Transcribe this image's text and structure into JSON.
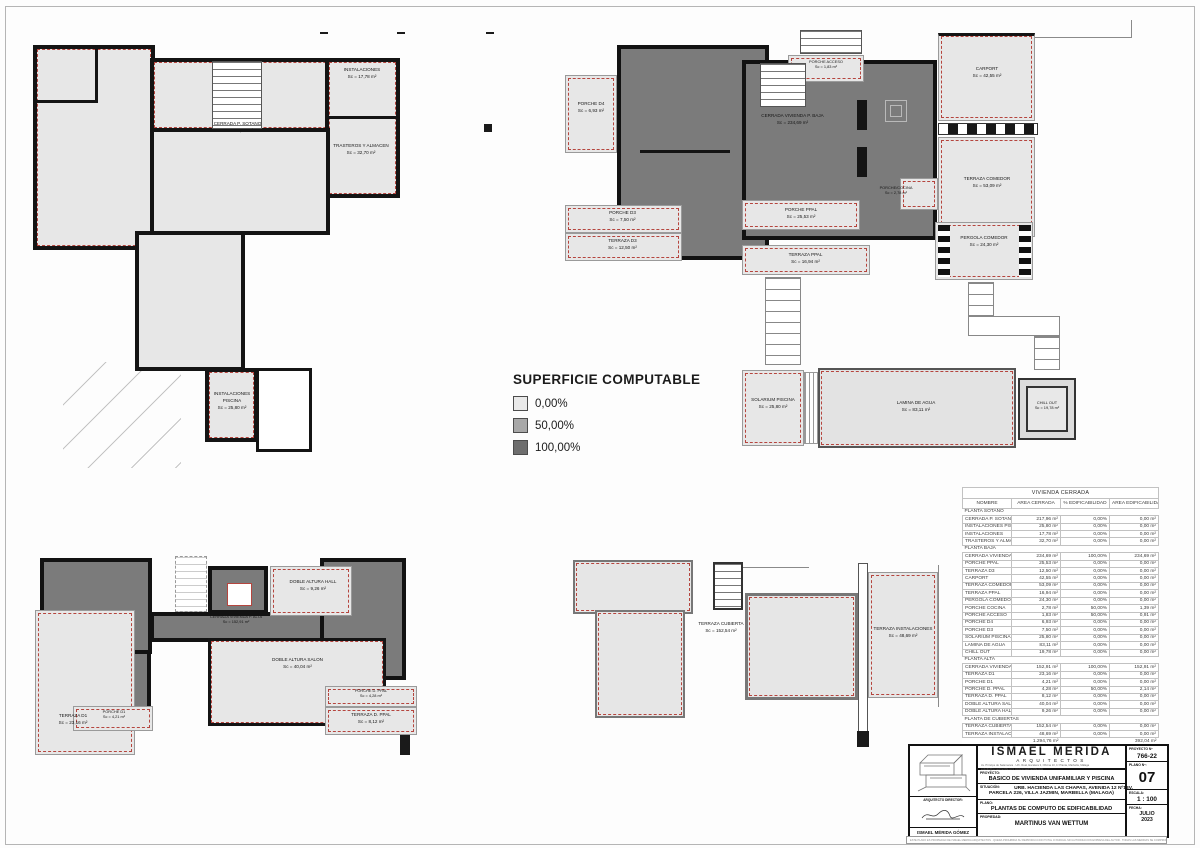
{
  "legend": {
    "title": "SUPERFICIE COMPUTABLE",
    "items": [
      {
        "label": "0,00%",
        "color": "#e9e9e9"
      },
      {
        "label": "50,00%",
        "color": "#a8a8a8"
      },
      {
        "label": "100,00%",
        "color": "#6e6e6e"
      }
    ]
  },
  "colors": {
    "pct0": "#e7e7e7",
    "pct50": "#a8a8a8",
    "pct100": "#7b7b7b",
    "wall": "#141414",
    "red_dash": "#b5453e"
  },
  "plans": {
    "sotano": {
      "rooms": [
        {
          "name": "INSTALACIONES",
          "area": "Sc = 17,78 m²"
        },
        {
          "name": "CERRADA P. SOTANO",
          "area": "Sc = 217,96 m²"
        },
        {
          "name": "TRASTEROS Y ALMACEN",
          "area": "Sc = 32,70 m²"
        },
        {
          "name": "INSTALACIONES PISCINA",
          "area": "Sc = 25,80 m²"
        }
      ]
    },
    "baja": {
      "rooms": [
        {
          "name": "PORCHE D4",
          "area": "Sc = 6,93 m²"
        },
        {
          "name": "PORCHE ACCESO",
          "area": "Sc = 1,83 m²"
        },
        {
          "name": "CERRADA VIVIENDA P. BAJA",
          "area": "Sc = 234,69 m²"
        },
        {
          "name": "CARPORT",
          "area": "Sc = 42,55 m²"
        },
        {
          "name": "TERRAZA COMEDOR",
          "area": "Sc = 53,09 m²"
        },
        {
          "name": "PORCHE/COCINA",
          "area": "Sc = 2,78 m²"
        },
        {
          "name": "PERGOLA COMEDOR",
          "area": "Sc = 24,30 m²"
        },
        {
          "name": "PORCHE D3",
          "area": "Sc = 7,50 m²"
        },
        {
          "name": "TERRAZA D3",
          "area": "Sc = 12,50 m²"
        },
        {
          "name": "PORCHE PPAL",
          "area": "Sc = 25,53 m²"
        },
        {
          "name": "TERRAZA PPAL",
          "area": "Sc = 16,94 m²"
        },
        {
          "name": "SOLARIUM PISCINA",
          "area": "Sc = 25,80 m²"
        },
        {
          "name": "LAMINA DE AGUA",
          "area": "Sc = 83,11 m²"
        },
        {
          "name": "CHILL OUT",
          "area": "Sc = 19,78 m²"
        }
      ]
    },
    "alta": {
      "rooms": [
        {
          "name": "DOBLE ALTURA HALL",
          "area": "Sc = 9,26 m²"
        },
        {
          "name": "CERRADA VIVIENDA P. ALTA",
          "area": "Sc = 152,91 m²"
        },
        {
          "name": "DOBLE ALTURA SALON",
          "area": "Sc = 40,04 m²"
        },
        {
          "name": "PORCHE D1",
          "area": "Sc = 4,21 m²"
        },
        {
          "name": "TERRAZA D1",
          "area": "Sc = 23,16 m²"
        },
        {
          "name": "PORCHE D. PPAL",
          "area": "Sc = 4,28 m²"
        },
        {
          "name": "TERRAZA D. PPAL",
          "area": "Sc = 8,12 m²"
        }
      ]
    },
    "cubierta": {
      "rooms": [
        {
          "name": "TERRAZA CUBIERTA",
          "area": "Sc = 152,54 m²"
        },
        {
          "name": "TERRAZA INSTALACIONES",
          "area": "Sc = 48,69 m²"
        }
      ]
    }
  },
  "table": {
    "title": "VIVIENDA CERRADA",
    "headers": [
      "NOMBRE",
      "AREA CERRADA",
      "% EDIFICABILIDAD",
      "AREA EDIFICABILIDAD"
    ],
    "rows": [
      {
        "section": true,
        "name": "PLANTA SOTANO"
      },
      {
        "name": "CERRADA P. SOTANO",
        "area": "217,96 m²",
        "pct": "0,00%",
        "edif": "0,00 m²"
      },
      {
        "name": "INSTALACIONES PISCINA",
        "area": "25,80 m²",
        "pct": "0,00%",
        "edif": "0,00 m²"
      },
      {
        "name": "INSTALACIONES",
        "area": "17,78 m²",
        "pct": "0,00%",
        "edif": "0,00 m²"
      },
      {
        "name": "TRASTEROS Y ALMACEN",
        "area": "32,70 m²",
        "pct": "0,00%",
        "edif": "0,00 m²"
      },
      {
        "section": true,
        "name": "PLANTA BAJA"
      },
      {
        "name": "CERRADA VIVIENDA P. BAJA",
        "area": "234,69 m²",
        "pct": "100,00%",
        "edif": "234,69 m²"
      },
      {
        "name": "PORCHE PPAL",
        "area": "25,53 m²",
        "pct": "0,00%",
        "edif": "0,00 m²"
      },
      {
        "name": "TERRAZA D3",
        "area": "12,50 m²",
        "pct": "0,00%",
        "edif": "0,00 m²"
      },
      {
        "name": "CARPORT",
        "area": "42,55 m²",
        "pct": "0,00%",
        "edif": "0,00 m²"
      },
      {
        "name": "TERRAZA COMEDOR",
        "area": "53,09 m²",
        "pct": "0,00%",
        "edif": "0,00 m²"
      },
      {
        "name": "TERRAZA PPAL",
        "area": "16,94 m²",
        "pct": "0,00%",
        "edif": "0,00 m²"
      },
      {
        "name": "PERGOLA COMEDOR",
        "area": "24,30 m²",
        "pct": "0,00%",
        "edif": "0,00 m²"
      },
      {
        "name": "PORCHE COCINA",
        "area": "2,78 m²",
        "pct": "50,00%",
        "edif": "1,39 m²"
      },
      {
        "name": "PORCHE ACCESO",
        "area": "1,83 m²",
        "pct": "50,00%",
        "edif": "0,91 m²"
      },
      {
        "name": "PORCHE D4",
        "area": "6,93 m²",
        "pct": "0,00%",
        "edif": "0,00 m²"
      },
      {
        "name": "PORCHE D3",
        "area": "7,50 m²",
        "pct": "0,00%",
        "edif": "0,00 m²"
      },
      {
        "name": "SOLARIUM PISCINA",
        "area": "25,80 m²",
        "pct": "0,00%",
        "edif": "0,00 m²"
      },
      {
        "name": "LAMINA DE AGUA",
        "area": "83,11 m²",
        "pct": "0,00%",
        "edif": "0,00 m²"
      },
      {
        "name": "CHILL OUT",
        "area": "19,78 m²",
        "pct": "0,00%",
        "edif": "0,00 m²"
      },
      {
        "section": true,
        "name": "PLANTA ALTA"
      },
      {
        "name": "CERRADA VIVIENDA P. ALTA",
        "area": "152,91 m²",
        "pct": "100,00%",
        "edif": "152,91 m²"
      },
      {
        "name": "TERRAZA D1",
        "area": "23,16 m²",
        "pct": "0,00%",
        "edif": "0,00 m²"
      },
      {
        "name": "PORCHE D1",
        "area": "4,21 m²",
        "pct": "0,00%",
        "edif": "0,00 m²"
      },
      {
        "name": "PORCHE D. PPAL",
        "area": "4,28 m²",
        "pct": "50,00%",
        "edif": "2,14 m²"
      },
      {
        "name": "TERRAZA D. PPAL",
        "area": "8,12 m²",
        "pct": "0,00%",
        "edif": "0,00 m²"
      },
      {
        "name": "DOBLE ALTURA SALON",
        "area": "40,04 m²",
        "pct": "0,00%",
        "edif": "0,00 m²"
      },
      {
        "name": "DOBLE ALTURA HALL",
        "area": "9,26 m²",
        "pct": "0,00%",
        "edif": "0,00 m²"
      },
      {
        "section": true,
        "name": "PLANTA DE CUBIERTAS"
      },
      {
        "name": "TERRAZA CUBIERTA",
        "area": "152,54 m²",
        "pct": "0,00%",
        "edif": "0,00 m²"
      },
      {
        "name": "TERRAZA INSTALACIONES",
        "area": "48,69 m²",
        "pct": "0,00%",
        "edif": "0,00 m²"
      }
    ],
    "total": {
      "area": "1.294,76 m²",
      "edif": "392,04 m²"
    }
  },
  "titleblock": {
    "studio_name": "ISMAEL MERIDA",
    "studio_sub": "ARQUITECTOS",
    "address_left": "Av. Príncipe de Salamanca · Urb. Real, Escalera 3, Oficina 10, 1ª Planta, Marbella, Málaga",
    "address_right": "estudio@ismaelmerida.com   www.ismaelmerida.com",
    "director_label": "ARQUITECTO DIRECTOR:",
    "director_name": "ISMAEL MÉRIDA GÓMEZ",
    "proyecto_label": "PROYECTO:",
    "proyecto": "BASICO DE VIVIENDA UNIFAMILIAR Y PISCINA",
    "situacion_label": "SITUACIÓN:",
    "situacion1": "URB. HACIENDA LAS CHAPAS, AVENIDA 12 Nº13V,",
    "situacion2": "PARCELA 226, VILLA JAZMIN, MARBELLA (MALAGA)",
    "plano_label": "PLANO:",
    "plano": "PLANTAS DE COMPUTO DE EDIFICABILIDAD",
    "propiedad_label": "PROPIEDAD:",
    "propiedad": "MARTINUS VAN WETTUM",
    "proyecto_num_label": "PROYECTO Nº",
    "proyecto_num": "766-22",
    "plano_num_label": "PLANO Nº:",
    "plano_num": "07",
    "escala_label": "ESCALA:",
    "escala": "1 : 100",
    "fecha_label": "FECHA:",
    "fecha1": "JULIO",
    "fecha2": "2023",
    "legal": "ESTE PLANO ES PROPIEDAD DE ISMAEL MERIDA ARQUITECTOS · QUEDA PROHIBIDA SU REPRODUCCION TOTAL O PARCIAL SIN AUTORIZACION EXPRESA DEL AUTOR · TODAS LAS MEDIDAS SE COMPROBARAN EN OBRA"
  }
}
